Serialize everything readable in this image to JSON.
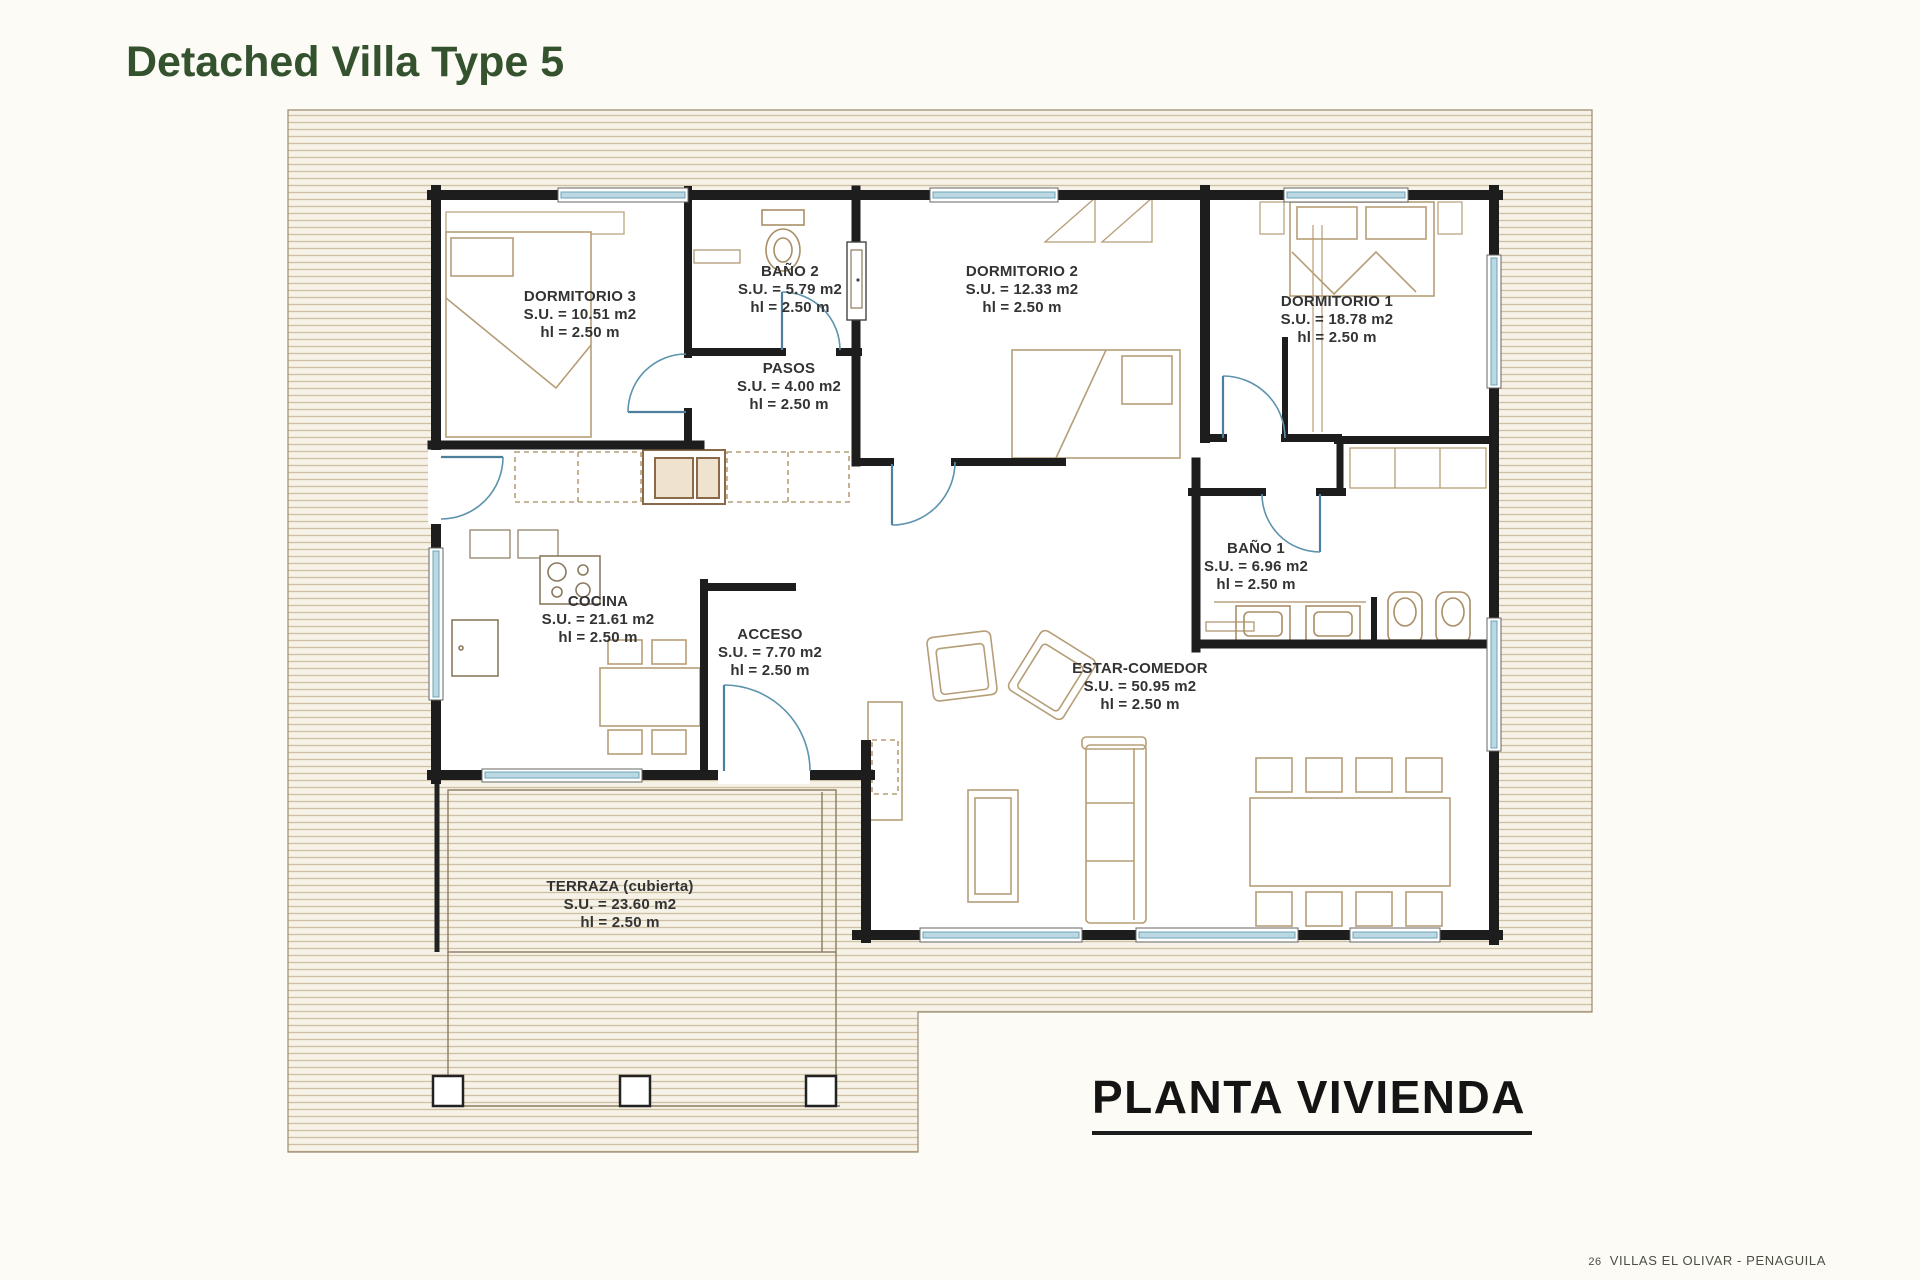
{
  "page": {
    "title": "Detached Villa Type 5",
    "caption": "PLANTA VIVIENDA",
    "footer": {
      "page_number": "26",
      "project": "VILLAS EL OLIVAR - PENAGUILA"
    }
  },
  "colors": {
    "title_green": "#35522f",
    "paper": "#fcfbf6",
    "wall_dark": "#1d1d1d",
    "glazing_blue": "#bcd9e3",
    "door_blue": "#5d93ad",
    "hatch_line_tan": "#cfc0a4",
    "furniture_tan": "#b59e77"
  },
  "rooms": [
    {
      "id": "dormitorio-3",
      "name": "DORMITORIO 3",
      "su": "S.U. = 10.51 m2",
      "hl": "hl = 2.50 m"
    },
    {
      "id": "bano-2",
      "name": "BAÑO 2",
      "su": "S.U. = 5.79 m2",
      "hl": "hl = 2.50 m"
    },
    {
      "id": "dormitorio-2",
      "name": "DORMITORIO 2",
      "su": "S.U. = 12.33 m2",
      "hl": "hl = 2.50 m"
    },
    {
      "id": "dormitorio-1",
      "name": "DORMITORIO 1",
      "su": "S.U. = 18.78 m2",
      "hl": "hl = 2.50 m"
    },
    {
      "id": "pasos",
      "name": "PASOS",
      "su": "S.U. = 4.00 m2",
      "hl": "hl = 2.50 m"
    },
    {
      "id": "cocina",
      "name": "COCINA",
      "su": "S.U. = 21.61 m2",
      "hl": "hl = 2.50 m"
    },
    {
      "id": "acceso",
      "name": "ACCESO",
      "su": "S.U. = 7.70 m2",
      "hl": "hl = 2.50 m"
    },
    {
      "id": "bano-1",
      "name": "BAÑO 1",
      "su": "S.U. = 6.96 m2",
      "hl": "hl = 2.50 m"
    },
    {
      "id": "estar-comedor",
      "name": "ESTAR-COMEDOR",
      "su": "S.U. = 50.95 m2",
      "hl": "hl = 2.50 m"
    },
    {
      "id": "terraza",
      "name": "TERRAZA (cubierta)",
      "su": "S.U. = 23.60 m2",
      "hl": "hl = 2.50 m"
    }
  ]
}
